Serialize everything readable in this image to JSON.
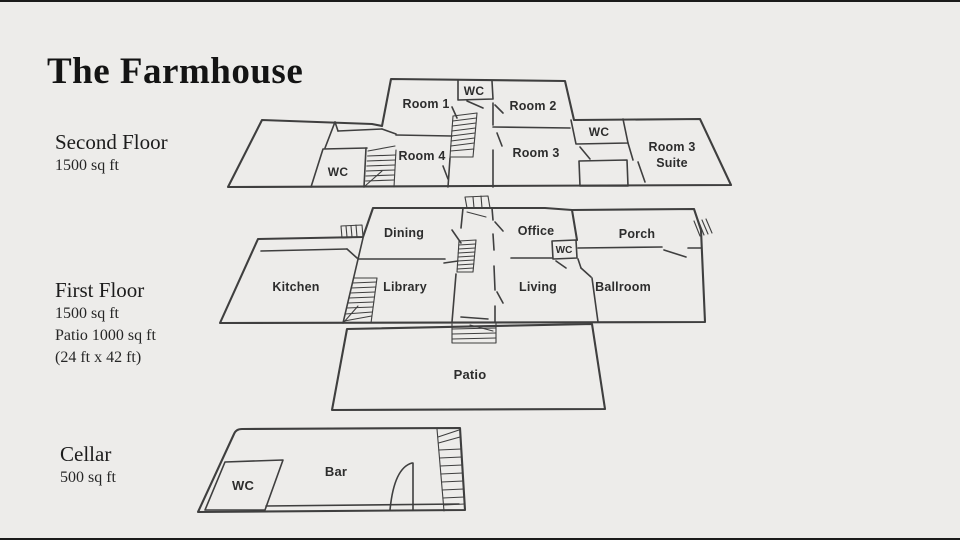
{
  "slide": {
    "title": "The Farmhouse"
  },
  "colors": {
    "bg": "#edecea",
    "ink": "#3f3f3f",
    "label": "#2d2d2d",
    "heading": "#141414",
    "border": "#1b1b1b"
  },
  "floors": {
    "second": {
      "heading": "Second Floor",
      "details": [
        "1500 sq ft"
      ]
    },
    "first": {
      "heading": "First Floor",
      "details": [
        "1500 sq ft",
        "Patio 1000 sq ft",
        "(24 ft x 42 ft)"
      ]
    },
    "cellar": {
      "heading": "Cellar",
      "details": [
        "500 sq ft"
      ]
    }
  },
  "rooms": {
    "second": {
      "wc_top": "WC",
      "room1": "Room 1",
      "room2": "Room 2",
      "room4": "Room 4",
      "room3": "Room 3",
      "wc_left": "WC",
      "wc_right": "WC",
      "suite_line1": "Room 3",
      "suite_line2": "Suite"
    },
    "first": {
      "dining": "Dining",
      "office": "Office",
      "porch": "Porch",
      "wc": "WC",
      "kitchen": "Kitchen",
      "library": "Library",
      "living": "Living",
      "ballroom": "Ballroom",
      "patio": "Patio"
    },
    "cellar": {
      "wc": "WC",
      "bar": "Bar"
    }
  }
}
